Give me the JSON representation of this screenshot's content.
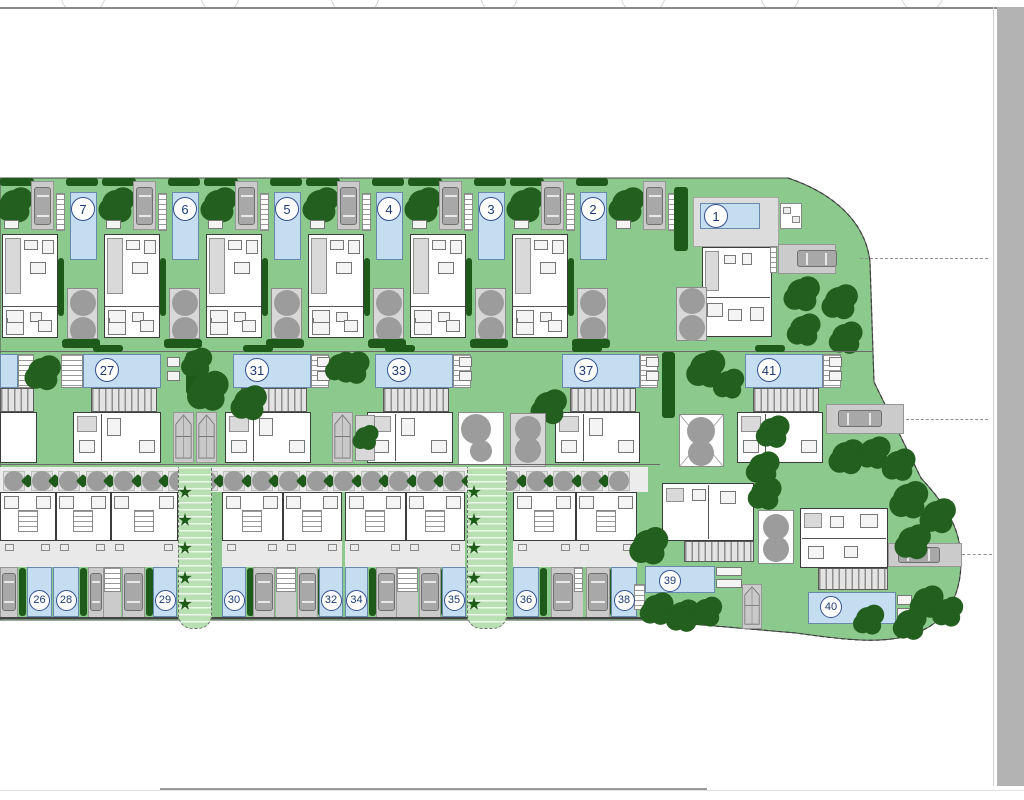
{
  "drawing": {
    "type": "residential development site plan",
    "units_total_visible": 22
  },
  "plots": {
    "top": [
      "7",
      "6",
      "5",
      "4",
      "3",
      "2"
    ],
    "villa1": [
      "1"
    ],
    "middle": [
      "27",
      "31",
      "33",
      "37",
      "41"
    ],
    "townhouses": [
      "26",
      "28",
      "29",
      "30",
      "32",
      "34",
      "35",
      "36",
      "38"
    ],
    "detached": [
      "39",
      "40"
    ]
  },
  "colors": {
    "lawn": "#8cc98c",
    "tree_dark": "#235f1e",
    "hedge": "#1e5a19",
    "pool_blue": "#c4ddf1",
    "pool_border": "#6889ab",
    "paving": "#cbcbcb",
    "walkway_green": "#b9e0b2",
    "number_text": "#1c3a70",
    "side_band": "#b3b3b3",
    "wall": "#3c3c3c",
    "patio_tree_gray": "#9c9c9c"
  },
  "layout": {
    "site_path": "M0,178 L788,178 C836,194 866,224 870,262 L874,382 L921,478 C946,505 961,529 961,561 C961,599 944,623 916,633 C886,645 846,640 796,633 L645,620 L0,620 Z",
    "boundary_dash_path": "M788,178 C836,194 866,224 870,262 L874,382 L921,478 C946,505 961,529 961,561 C961,599 944,623 916,633 C886,645 846,640 796,633 L645,620",
    "top_row": {
      "y": 178,
      "units_x": [
        0,
        102,
        204,
        306,
        408,
        510
      ]
    },
    "extra_bay": {
      "tree": [
        626,
        204
      ],
      "table_x": 616,
      "carport_x": 643,
      "stairs_x": 668,
      "hedgecol": [
        674,
        187,
        14,
        64
      ]
    },
    "villa1": {
      "terrace": [
        693,
        197,
        86,
        50
      ],
      "pool": [
        700,
        203,
        60,
        26
      ],
      "circle": [
        716,
        216
      ],
      "utility": [
        780,
        203,
        22,
        26
      ],
      "house": [
        702,
        247,
        70,
        90
      ],
      "patio": [
        676,
        287,
        31,
        54
      ],
      "patio_circles": [
        [
          692,
          301
        ],
        [
          692,
          328
        ]
      ],
      "steps": [
        770,
        246,
        7,
        27
      ],
      "driveway": [
        778,
        244,
        58,
        30
      ],
      "car": [
        797,
        250,
        40,
        17
      ],
      "trees": [
        [
          801,
          293,
          14
        ],
        [
          839,
          301,
          14
        ],
        [
          803,
          329,
          13
        ],
        [
          845,
          337,
          13
        ]
      ],
      "dash_y": 258
    },
    "middle_row": {
      "y": 352,
      "partial": {
        "pool": [
          0,
          354,
          18,
          34
        ],
        "terr": [
          18,
          354,
          16,
          34
        ],
        "pergola": [
          0,
          388,
          34,
          24
        ],
        "house": [
          0,
          412,
          37,
          51
        ]
      },
      "units": [
        {
          "p": 83,
          "terr": "L",
          "house_x": 73,
          "house_w": 88
        },
        {
          "p": 233,
          "terr": "R",
          "house_x": 225,
          "house_w": 86
        },
        {
          "p": 375,
          "terr": "R",
          "house_x": 367,
          "house_w": 86
        },
        {
          "p": 562,
          "terr": "R",
          "house_x": 555,
          "house_w": 85
        },
        {
          "p": 745,
          "terr": "R",
          "house_x": 737,
          "house_w": 86
        }
      ],
      "unit_trees": [
        [
          42,
          372,
          14
        ],
        [
          352,
          367,
          13
        ],
        [
          548,
          406,
          14
        ],
        [
          705,
          368,
          15
        ],
        [
          728,
          383,
          12
        ]
      ],
      "divider_trees": [
        [
          196,
          362,
          12
        ],
        [
          207,
          390,
          16
        ],
        [
          248,
          402,
          14
        ],
        [
          340,
          366,
          12
        ],
        [
          365,
          437,
          10
        ]
      ],
      "trailer_pads": [
        [
          173,
          412,
          21,
          51
        ],
        [
          196,
          412,
          21,
          51
        ],
        [
          332,
          412,
          21,
          51
        ]
      ],
      "hedgecols": [
        [
          186,
          352,
          16,
          42
        ],
        [
          662,
          352,
          13,
          66
        ]
      ],
      "graysq": [
        355,
        415,
        20,
        46
      ],
      "patio_white": {
        "rect": [
          458,
          412,
          46,
          53
        ],
        "circles": [
          [
            476,
            429,
            15
          ],
          [
            481,
            451,
            11
          ]
        ]
      },
      "patio_gray": {
        "rect": [
          510,
          413,
          36,
          54
        ],
        "circles": [
          [
            528,
            429,
            13
          ],
          [
            528,
            450,
            13
          ]
        ]
      },
      "patio_x": {
        "rect": [
          679,
          414,
          45,
          53
        ],
        "circles": [
          [
            701,
            431,
            14
          ],
          [
            701,
            453,
            13
          ]
        ]
      },
      "driveway41": {
        "rect": [
          826,
          404,
          78,
          30
        ],
        "car": [
          838,
          410,
          44,
          17
        ],
        "dash_y": 419
      }
    },
    "alley": {
      "rect": [
        0,
        467,
        648,
        25
      ],
      "start": 14,
      "step": 27.5,
      "count": 23,
      "cy": 481
    },
    "walkways": [
      {
        "x": 178,
        "w": 34
      },
      {
        "x": 467,
        "w": 40
      }
    ],
    "walkway_palm_ys": [
      492,
      520,
      548,
      578,
      604
    ],
    "th_blocks": [
      {
        "x": 0,
        "w": 178,
        "units": [
          0,
          55,
          110
        ],
        "unit_ws": [
          55,
          55,
          68
        ]
      },
      {
        "x": 222,
        "w": 120,
        "units": [
          0,
          60
        ],
        "unit_ws": [
          60,
          60
        ]
      },
      {
        "x": 345,
        "w": 120,
        "units": [
          0,
          60
        ],
        "unit_ws": [
          60,
          60
        ]
      },
      {
        "x": 513,
        "w": 124,
        "units": [
          0,
          62
        ],
        "unit_ws": [
          62,
          62
        ]
      }
    ],
    "th_pools": [
      [
        27,
        25
      ],
      [
        53,
        26
      ],
      [
        153,
        24
      ],
      [
        222,
        24
      ],
      [
        319,
        24
      ],
      [
        345,
        23
      ],
      [
        442,
        24
      ],
      [
        513,
        26
      ],
      [
        611,
        26
      ]
    ],
    "th_hedges": [
      19,
      80,
      146,
      247,
      312,
      369,
      435,
      540,
      604
    ],
    "th_carports": [
      [
        0,
        18
      ],
      [
        88,
        16
      ],
      [
        122,
        23
      ],
      [
        253,
        22
      ],
      [
        297,
        21
      ],
      [
        376,
        21
      ],
      [
        419,
        22
      ],
      [
        551,
        24
      ],
      [
        586,
        24
      ]
    ],
    "th_stairs": [
      [
        104,
        17
      ],
      [
        276,
        20
      ],
      [
        397,
        21
      ],
      [
        574,
        9
      ]
    ],
    "plot39": {
      "house": [
        662,
        483,
        92,
        58
      ],
      "deck": [
        684,
        541,
        70,
        21
      ],
      "patio": [
        758,
        510,
        36,
        54
      ],
      "patio_circles": [
        [
          776,
          527,
          13
        ],
        [
          776,
          549,
          13
        ]
      ],
      "pool": [
        645,
        566,
        70,
        27
      ],
      "circle": [
        670,
        581
      ],
      "furn": [
        [
          716,
          567,
          26,
          9
        ],
        [
          716,
          579,
          26,
          9
        ]
      ],
      "stairs": [
        634,
        584,
        11,
        26
      ],
      "trailer": [
        742,
        584,
        20,
        45
      ],
      "trees": [
        [
          648,
          545,
          15
        ],
        [
          656,
          608,
          13
        ],
        [
          682,
          615,
          13
        ],
        [
          706,
          611,
          12
        ]
      ]
    },
    "plot40": {
      "house": [
        800,
        508,
        88,
        60
      ],
      "deck": [
        818,
        568,
        70,
        22
      ],
      "pool": [
        808,
        592,
        88,
        32
      ],
      "circle": [
        831,
        607
      ],
      "furn": [
        [
          897,
          595,
          15,
          10
        ],
        [
          897,
          608,
          15,
          10
        ]
      ],
      "driveway": [
        888,
        543,
        74,
        24
      ],
      "car": [
        898,
        547,
        42,
        16
      ],
      "dash_y": 554
    },
    "blob_trees": [
      [
        772,
        431,
        13
      ],
      [
        846,
        456,
        14
      ],
      [
        873,
        452,
        13
      ],
      [
        898,
        464,
        13
      ],
      [
        908,
        499,
        15
      ],
      [
        937,
        515,
        14
      ],
      [
        912,
        541,
        14
      ],
      [
        762,
        467,
        13
      ],
      [
        764,
        493,
        13
      ],
      [
        926,
        601,
        13
      ],
      [
        947,
        611,
        12
      ],
      [
        909,
        623,
        13
      ],
      [
        868,
        619,
        12
      ]
    ],
    "band": {
      "x": 997,
      "y": 7,
      "w": 27,
      "h": 779
    },
    "top_line_y": 7,
    "bottom_light_y": 790,
    "bottom_dark": [
      160,
      788,
      547
    ]
  }
}
